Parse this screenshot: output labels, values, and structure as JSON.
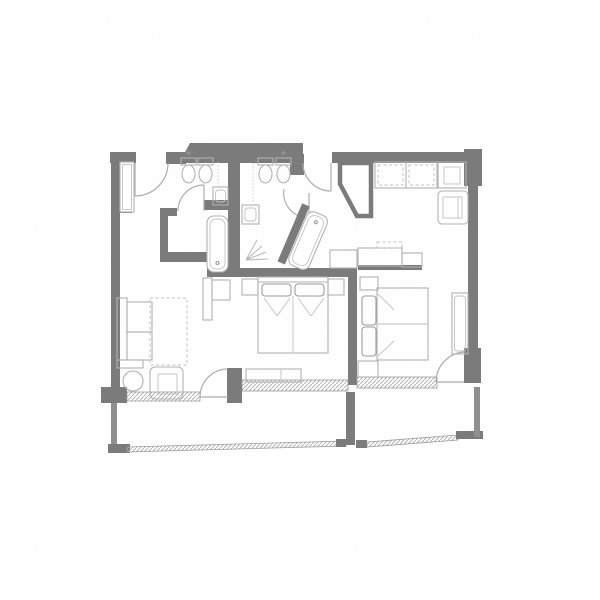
{
  "colors": {
    "background": "#fefefe",
    "wall": "#7b7b7b",
    "wall_light": "#8f8f8f",
    "furniture": "#b2b2b2",
    "furniture_dark": "#9c9c9c",
    "hatch": "#b7b7b7",
    "arc": "#adadad",
    "dashed": "#c3c3c3"
  },
  "plan": {
    "drawing_type": "architectural floor plan, two hotel suites with shared balcony",
    "visible_elements": [
      "exterior-walls",
      "interior-partition-walls",
      "entry-door-left-suite",
      "entry-door-right-suite",
      "bathroom-left (toilet, bidet, sink, bathtub)",
      "bathroom-right (toilet, bidet, sink, angled-bathtub)",
      "entry-closet-left",
      "angled-closet-right",
      "wardrobe-right-suite",
      "corner-cabinet",
      "armchair-top-right",
      "console-desk-right-suite",
      "double-bed-left-suite with nightstands",
      "double-bed-right-suite with nightstands",
      "sofa",
      "dashed-rug",
      "tv-console",
      "round-side-table",
      "armchair-bottom-left",
      "window-bench",
      "window-sills-hatched",
      "balcony-left",
      "balcony-right",
      "balcony-divider",
      "sloped-balcony-railing"
    ]
  }
}
